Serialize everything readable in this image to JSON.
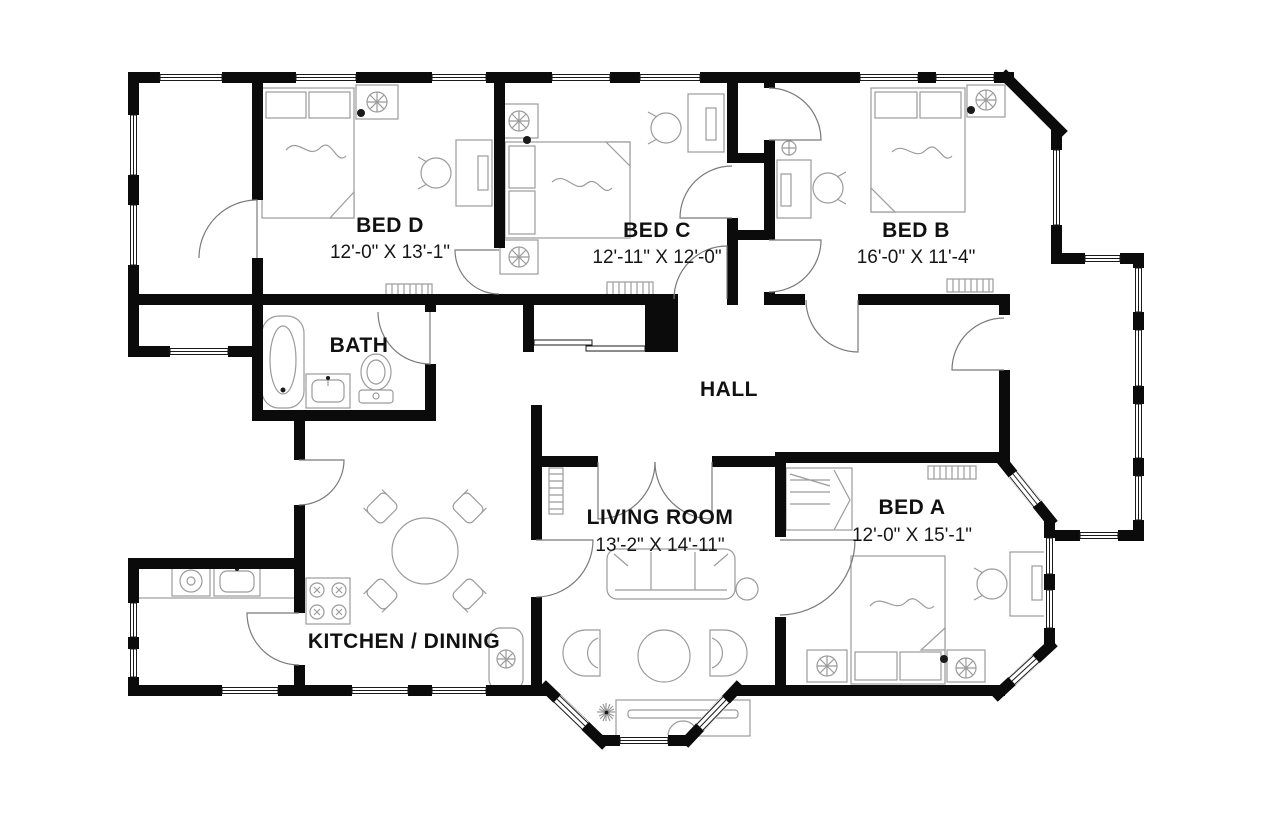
{
  "rooms": [
    {
      "name": "BED D",
      "dimensions": "12'-0\" X 13'-1\""
    },
    {
      "name": "BED C",
      "dimensions": "12'-11\" X 12'-0\""
    },
    {
      "name": "BED B",
      "dimensions": "16'-0\" X 11'-4\""
    },
    {
      "name": "BED A",
      "dimensions": "12'-0\" X 15'-1\""
    },
    {
      "name": "LIVING ROOM",
      "dimensions": "13'-2\" X 14'-11\""
    },
    {
      "name": "KITCHEN / DINING",
      "dimensions": ""
    },
    {
      "name": "BATH",
      "dimensions": ""
    },
    {
      "name": "HALL",
      "dimensions": ""
    }
  ],
  "colors": {
    "wall": "#0b0b0b",
    "furniture_line": "#9b9b9b",
    "text": "#111111",
    "background": "#ffffff"
  },
  "icons": [
    "bed-icon",
    "pillow-icon",
    "desk-icon",
    "chair-icon",
    "ceiling-light-icon",
    "sprinkler-icon",
    "wardrobe-icon",
    "bathtub-icon",
    "vanity-sink-icon",
    "toilet-icon",
    "sofa-icon",
    "armchair-icon",
    "coffee-table-icon",
    "tv-console-icon",
    "side-table-icon",
    "dining-table-icon",
    "stove-icon",
    "dishwasher-icon",
    "kitchen-sink-icon",
    "radiator-icon",
    "plant-icon",
    "water-heater-icon",
    "window-icon",
    "door-arc-icon",
    "sliding-door-icon",
    "chimney-icon"
  ]
}
